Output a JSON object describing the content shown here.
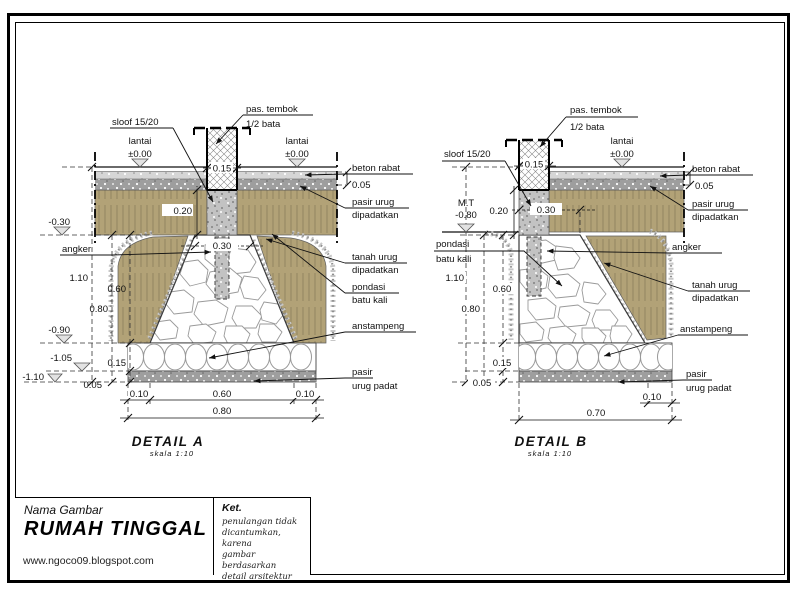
{
  "colors": {
    "backfill_tan": "#b2a277",
    "stipple_gray": "#9e9e9e"
  },
  "detail_a": {
    "title": "DETAIL A",
    "scale": "skala 1:10",
    "labels": {
      "sloof": "sloof 15/20",
      "wall_1": "pas. tembok",
      "wall_2": "1/2 bata",
      "lantai": "lantai",
      "lantai_level": "±0.00",
      "angker": "angker",
      "beton_rabat": "beton rabat",
      "rabat_dim": "0.05",
      "pasir_urug_1": "pasir urug",
      "pasir_urug_2": "dipadatkan",
      "tanah_urug_1": "tanah urug",
      "tanah_urug_2": "dipadatkan",
      "pondasi_1": "pondasi",
      "pondasi_2": "batu kali",
      "anstampeng": "anstampeng",
      "pasir_padat_1": "pasir",
      "pasir_padat_2": "urug padat"
    },
    "dims": {
      "wall": "0.15",
      "sloof_h": "0.20",
      "top_w": "0.30",
      "h_total": "1.10",
      "h_080": "0.80",
      "h_pondasi": "0.60",
      "h_anstampeng": "0.15",
      "h_pasir": "0.05",
      "bot_left": "0.10",
      "bot_mid": "0.60",
      "bot_right": "0.10",
      "bot_total": "0.80"
    },
    "levels": {
      "m030": "-0.30",
      "m090": "-0.90",
      "m105": "-1.05",
      "m110": "-1.10"
    }
  },
  "detail_b": {
    "title": "DETAIL B",
    "scale": "skala 1:10",
    "labels": {
      "sloof": "sloof 15/20",
      "wall_1": "pas. tembok",
      "wall_2": "1/2 bata",
      "lantai": "lantai",
      "lantai_level": "±0.00",
      "mt": "M.T",
      "mt_level": "-0.80",
      "pondasi_1": "pondasi",
      "pondasi_2": "batu kali",
      "angker": "angker",
      "beton_rabat": "beton rabat",
      "rabat_dim": "0.05",
      "pasir_urug_1": "pasir urug",
      "pasir_urug_2": "dipadatkan",
      "tanah_urug_1": "tanah urug",
      "tanah_urug_2": "dipadatkan",
      "anstampeng": "anstampeng",
      "pasir_padat_1": "pasir",
      "pasir_padat_2": "urug padat"
    },
    "dims": {
      "wall": "0.15",
      "sloof_h": "0.20",
      "top_w": "0.30",
      "h_total": "1.10",
      "h_080": "0.80",
      "h_pondasi": "0.60",
      "h_anstampeng": "0.15",
      "h_pasir": "0.05",
      "bot_right": "0.10",
      "bot_total": "0.70"
    }
  },
  "title_block": {
    "name_label": "Nama Gambar",
    "project": "RUMAH TINGGAL",
    "website": "www.ngoco09.blogspot.com",
    "notes_title": "Ket.",
    "note_1": "penulangan tidak",
    "note_2": "dicantumkan, karena",
    "note_3": "gambar berdasarkan",
    "note_4": "detail arsitektur"
  }
}
